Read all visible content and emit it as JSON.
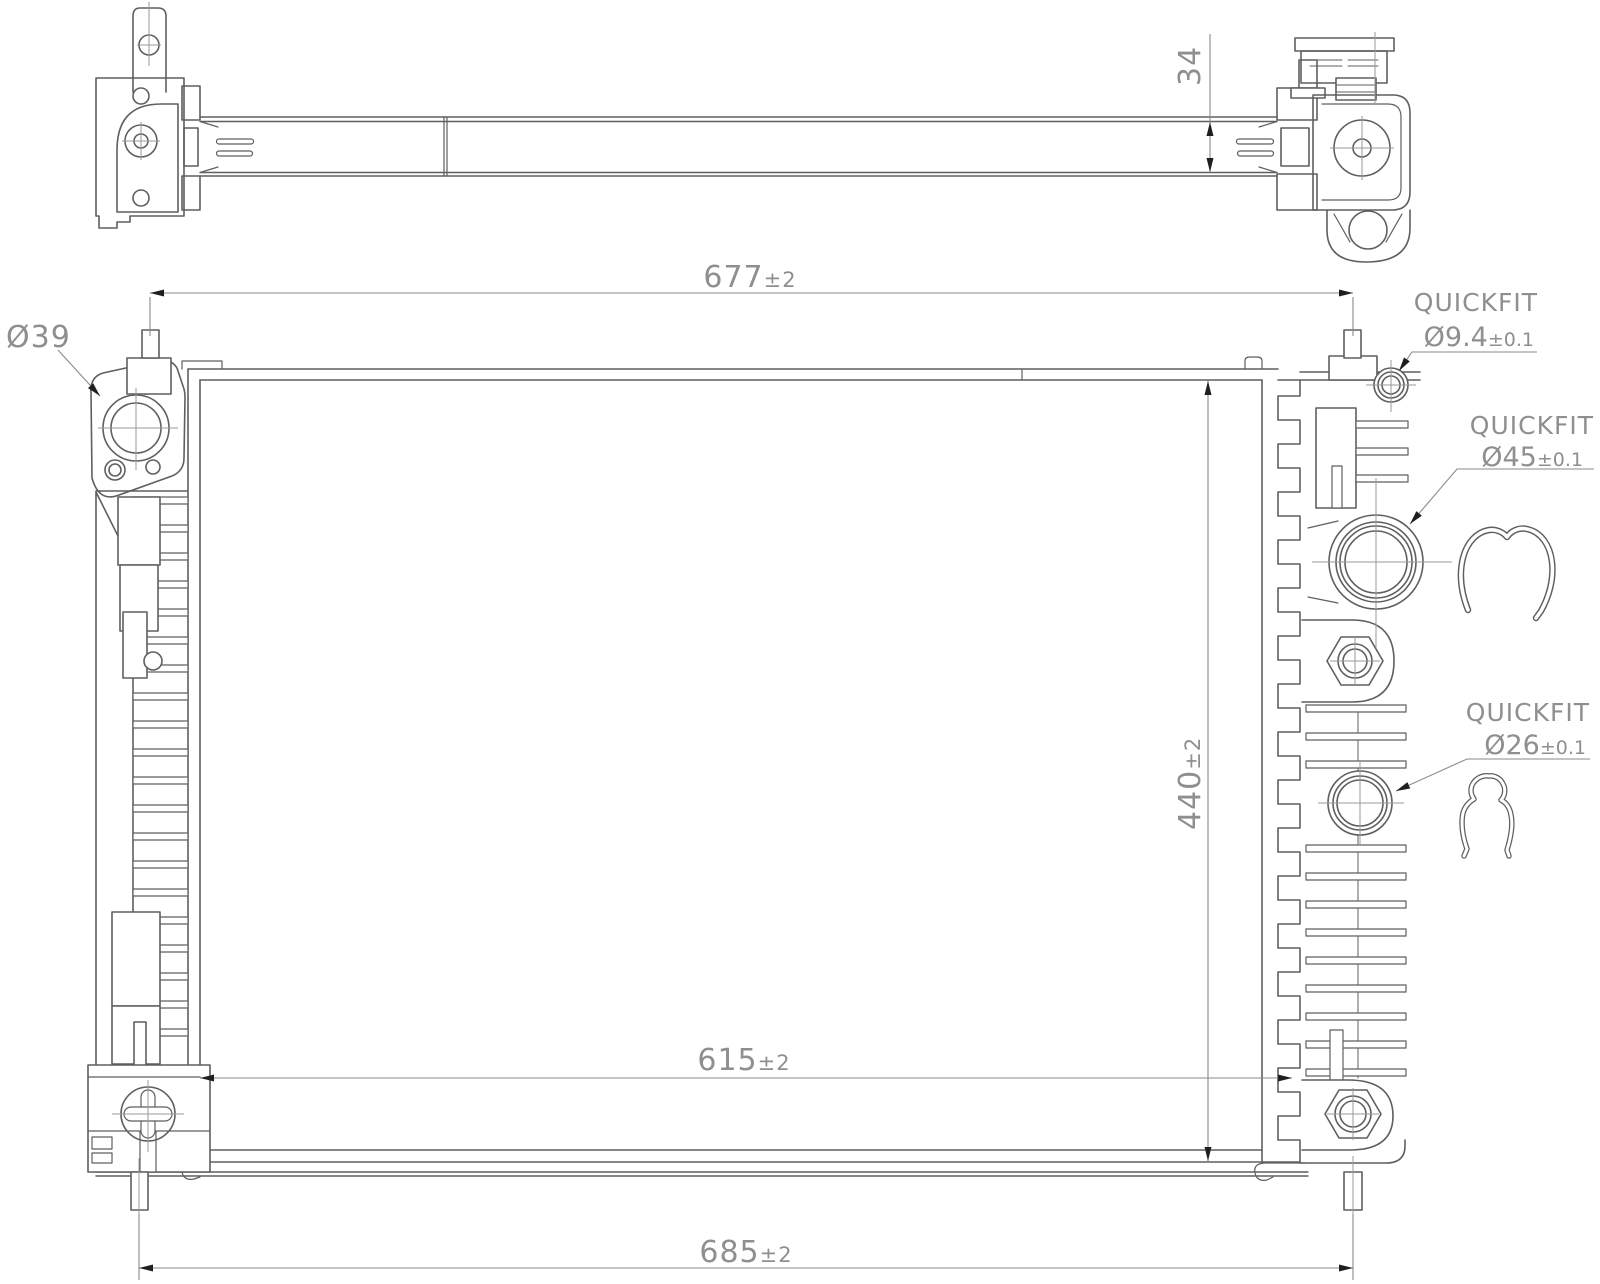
{
  "colors": {
    "background": "#ffffff",
    "line": "#5f5f5f",
    "dim_line": "#8a8a8a",
    "centerline": "#9a9a9a",
    "text": "#8f8f8f",
    "arrow": "#1f1f1f"
  },
  "dimensions": {
    "thickness": {
      "value": "34",
      "tol": ""
    },
    "top_span": {
      "value": "677",
      "tol": "±2"
    },
    "core_height": {
      "value": "440",
      "tol": "±2"
    },
    "inner_span": {
      "value": "615",
      "tol": "±2"
    },
    "overall_span": {
      "value": "685",
      "tol": "±2"
    }
  },
  "labels": {
    "inlet": {
      "text": "Ø39"
    },
    "quickfit_top": {
      "title": "QUICKFIT",
      "value": "Ø9.4",
      "tol": "±0.1"
    },
    "quickfit_mid": {
      "title": "QUICKFIT",
      "value": "Ø45",
      "tol": "±0.1"
    },
    "quickfit_low": {
      "title": "QUICKFIT",
      "value": "Ø26",
      "tol": "±0.1"
    }
  }
}
